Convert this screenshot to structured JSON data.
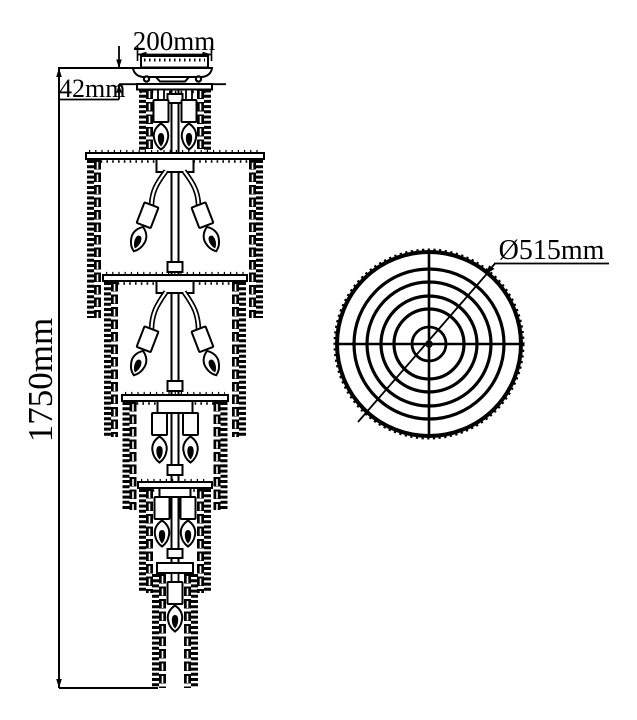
{
  "page": {
    "background": "#ffffff",
    "line_color": "#000000"
  },
  "front_view": {
    "canopy_width_label": "200mm",
    "canopy_height_label": "42mm",
    "total_height_label": "1750mm"
  },
  "top_view": {
    "diameter_label": "Ø515mm"
  }
}
